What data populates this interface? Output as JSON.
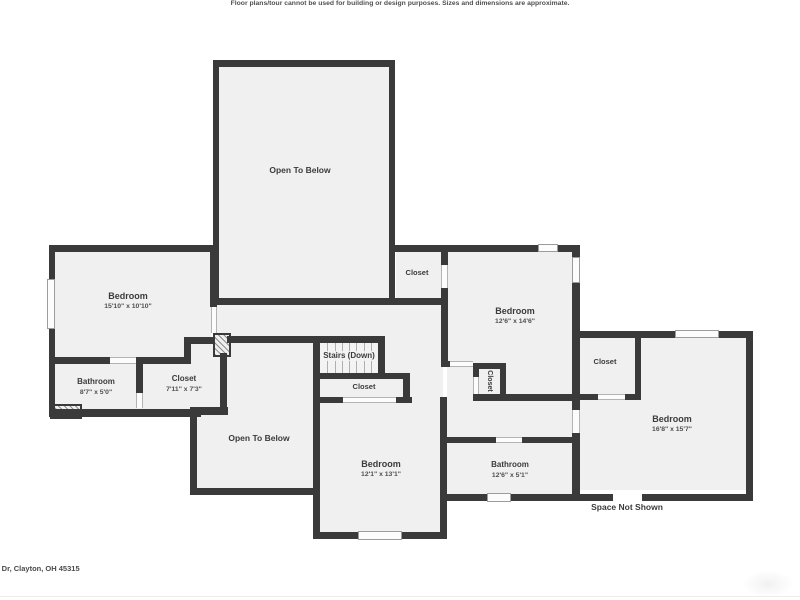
{
  "title": "Second floor residential floor plan",
  "colors": {
    "wall": "#3a3a3a",
    "floor": "#f0f0f0",
    "window_fill": "#fcfcfc",
    "window_border": "#9c9c9c",
    "door_line": "#b3b3b3",
    "label_text": "#3b3b3b",
    "dims_text": "#4f4f4f",
    "footer_text": "#4a4a4a",
    "footer_divider": "#ececec",
    "background": "#ffffff"
  },
  "plan": {
    "floors": [
      [
        219,
        66,
        171,
        233
      ],
      [
        55,
        251,
        156,
        159
      ],
      [
        205,
        340,
        17,
        68
      ],
      [
        213,
        305,
        230,
        38
      ],
      [
        385,
        336,
        58,
        67
      ],
      [
        320,
        342,
        83,
        55
      ],
      [
        197,
        343,
        116,
        146
      ],
      [
        320,
        403,
        120,
        130
      ],
      [
        396,
        252,
        46,
        48
      ],
      [
        447,
        251,
        125,
        143
      ],
      [
        447,
        369,
        125,
        68
      ],
      [
        447,
        443,
        125,
        52
      ],
      [
        579,
        338,
        167,
        152
      ]
    ],
    "walls": [
      [
        213,
        60,
        182,
        7
      ],
      [
        213,
        60,
        6,
        245
      ],
      [
        389,
        60,
        6,
        245
      ],
      [
        213,
        298,
        235,
        7
      ],
      [
        49,
        245,
        168,
        7
      ],
      [
        49,
        245,
        6,
        172
      ],
      [
        49,
        409,
        152,
        8
      ],
      [
        210,
        245,
        7,
        62
      ],
      [
        49,
        357,
        61,
        7
      ],
      [
        136,
        357,
        55,
        7
      ],
      [
        184,
        337,
        7,
        27
      ],
      [
        184,
        337,
        29,
        7
      ],
      [
        136,
        364,
        7,
        30
      ],
      [
        227,
        336,
        158,
        7
      ],
      [
        190,
        407,
        38,
        8
      ],
      [
        220,
        353,
        7,
        56
      ],
      [
        190,
        409,
        7,
        86
      ],
      [
        190,
        488,
        127,
        7
      ],
      [
        313,
        336,
        7,
        203
      ],
      [
        378,
        336,
        7,
        43
      ],
      [
        313,
        373,
        97,
        6
      ],
      [
        403,
        373,
        7,
        30
      ],
      [
        313,
        397,
        30,
        6
      ],
      [
        396,
        397,
        16,
        6
      ],
      [
        313,
        532,
        134,
        7
      ],
      [
        440,
        397,
        7,
        142
      ],
      [
        390,
        245,
        188,
        7
      ],
      [
        441,
        249,
        7,
        16
      ],
      [
        441,
        288,
        7,
        79
      ],
      [
        441,
        361,
        9,
        6
      ],
      [
        473,
        363,
        33,
        6
      ],
      [
        500,
        363,
        6,
        38
      ],
      [
        473,
        363,
        6,
        14
      ],
      [
        473,
        394,
        104,
        7
      ],
      [
        572,
        245,
        8,
        255
      ],
      [
        445,
        437,
        51,
        6
      ],
      [
        522,
        437,
        55,
        6
      ],
      [
        443,
        494,
        310,
        7
      ],
      [
        572,
        331,
        181,
        7
      ],
      [
        746,
        331,
        7,
        170
      ],
      [
        635,
        338,
        6,
        62
      ],
      [
        575,
        394,
        23,
        6
      ],
      [
        625,
        394,
        16,
        6
      ]
    ],
    "windows": [
      [
        47,
        279,
        8,
        50
      ],
      [
        538,
        244,
        20,
        8
      ],
      [
        572,
        257,
        8,
        26
      ],
      [
        675,
        330,
        44,
        8
      ],
      [
        358,
        531,
        44,
        9
      ],
      [
        487,
        493,
        24,
        9
      ]
    ],
    "doors": [
      [
        110,
        357,
        26,
        7,
        "h"
      ],
      [
        136,
        393,
        7,
        15,
        "v"
      ],
      [
        211,
        307,
        6,
        26,
        "v"
      ],
      [
        343,
        397,
        53,
        6,
        "h"
      ],
      [
        450,
        361,
        23,
        6,
        "h"
      ],
      [
        441,
        265,
        7,
        23,
        "v"
      ],
      [
        473,
        377,
        6,
        17,
        "v"
      ],
      [
        496,
        437,
        26,
        6,
        "h"
      ],
      [
        572,
        410,
        8,
        23,
        "v"
      ],
      [
        598,
        394,
        27,
        6,
        "h"
      ],
      [
        613,
        494,
        29,
        7,
        "p"
      ]
    ],
    "hatches": [
      [
        50,
        404,
        32,
        15
      ],
      [
        213,
        333,
        18,
        24
      ]
    ],
    "stairs": {
      "x": 320,
      "y": 342,
      "w": 58,
      "h": 31,
      "treads": 7
    },
    "labels": [
      {
        "id": "bedroom-left",
        "name": "Bedroom",
        "dims": "15'10\" x 10'10\"",
        "cx": 128,
        "cy": 301,
        "size": 9
      },
      {
        "id": "bathroom-left",
        "name": "Bathroom",
        "dims": "8'7\" x 5'0\"",
        "cx": 96,
        "cy": 387,
        "size": 8
      },
      {
        "id": "closet-left",
        "name": "Closet",
        "dims": "7'11\" x 7'3\"",
        "cx": 184,
        "cy": 384,
        "size": 8
      },
      {
        "id": "open-to-below-main",
        "name": "Open To Below",
        "cx": 300,
        "cy": 170,
        "size": 8.5
      },
      {
        "id": "closet-top",
        "name": "Closet",
        "cx": 417,
        "cy": 273,
        "size": 7.5
      },
      {
        "id": "bedroom-northeast",
        "name": "Bedroom",
        "dims": "12'6\" x 14'6\"",
        "cx": 515,
        "cy": 316,
        "size": 9
      },
      {
        "id": "stairs",
        "name": "Stairs (Down)",
        "cx": 349,
        "cy": 356,
        "size": 8,
        "halo": true
      },
      {
        "id": "closet-mid",
        "name": "Closet",
        "cx": 364,
        "cy": 387,
        "size": 7.5
      },
      {
        "id": "open-to-below-second",
        "name": "Open To Below",
        "cx": 259,
        "cy": 438,
        "size": 8.5
      },
      {
        "id": "bedroom-south",
        "name": "Bedroom",
        "dims": "12'1\" x 13'1\"",
        "cx": 381,
        "cy": 469,
        "size": 9
      },
      {
        "id": "closet-small",
        "name": "Closet",
        "cx": 489,
        "cy": 381,
        "size": 7,
        "rot": true
      },
      {
        "id": "bathroom-mid",
        "name": "Bathroom",
        "dims": "12'6\" x 5'1\"",
        "cx": 510,
        "cy": 470,
        "size": 8
      },
      {
        "id": "closet-east",
        "name": "Closet",
        "cx": 605,
        "cy": 362,
        "size": 7.5
      },
      {
        "id": "bedroom-east",
        "name": "Bedroom",
        "dims": "16'8\" x 15'7\"",
        "cx": 672,
        "cy": 424,
        "size": 9
      },
      {
        "id": "space-not-shown",
        "name": "Space Not Shown",
        "cx": 627,
        "cy": 507,
        "size": 8.5
      }
    ]
  },
  "footer": {
    "address": "n Dr, Clayton, OH 45315",
    "disclaimer": "Floor plans/tour cannot be used for building or design purposes. Sizes and dimensions are approximate."
  }
}
